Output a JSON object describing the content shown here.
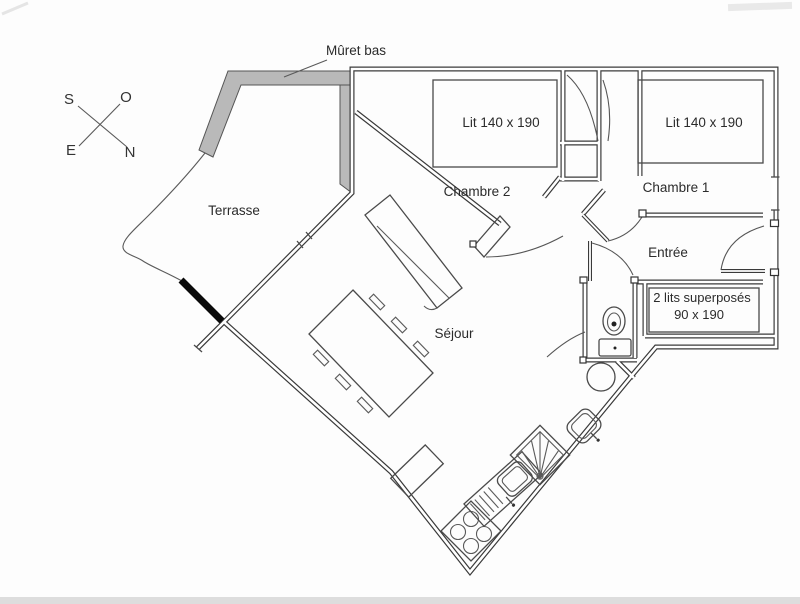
{
  "plan": {
    "annotations": {
      "muret_bas": "Mûret bas"
    },
    "compass": {
      "south": "S",
      "ouest": "O",
      "est": "E",
      "nord": "N"
    },
    "rooms": {
      "terrasse": {
        "label": "Terrasse"
      },
      "chambre2": {
        "label": "Chambre 2",
        "bed_label": "Lit 140 x 190"
      },
      "chambre1": {
        "label": "Chambre 1",
        "bed_label": "Lit 140 x 190"
      },
      "sejour": {
        "label": "Séjour"
      },
      "entree": {
        "label": "Entrée"
      },
      "bunks": {
        "line1": "2 lits superposés",
        "line2": "90 x 190"
      }
    },
    "colors": {
      "wall": "#3a3a3a",
      "muret_fill": "#b9b9b9",
      "text": "#2b2b2b",
      "accent": "#0a0a0a",
      "background": "#fdfdfd"
    }
  }
}
